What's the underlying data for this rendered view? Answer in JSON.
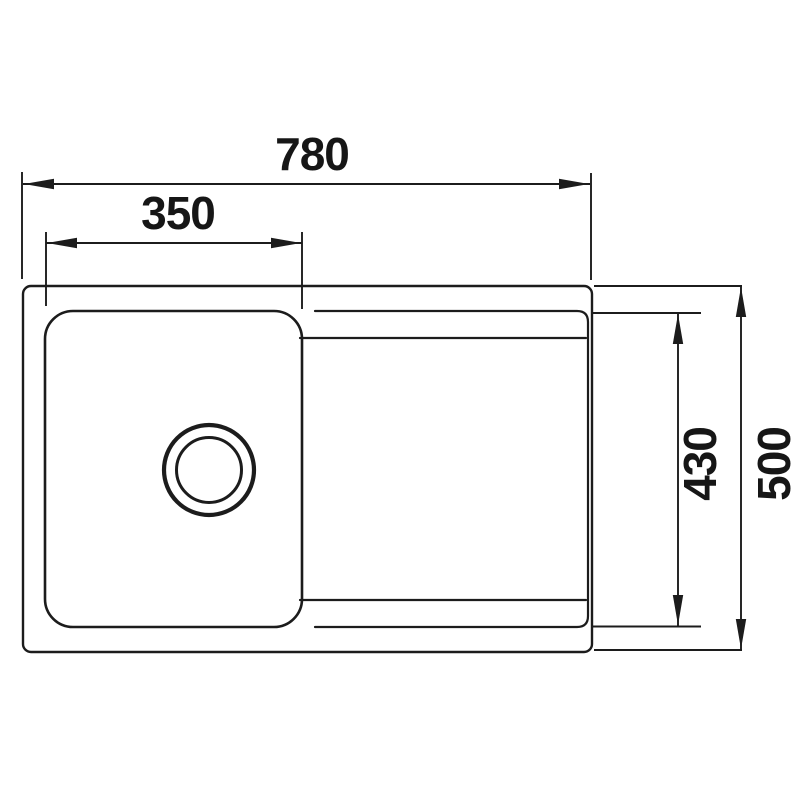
{
  "diagram": {
    "type": "technical-drawing",
    "subject": "kitchen sink with bowl and drainboard, top view, dimensioned",
    "colors": {
      "line": "#1c1c1c",
      "text": "#161616",
      "background": "#ffffff"
    },
    "dimensions": [
      {
        "id": "overall-width",
        "label": "780",
        "orientation": "horizontal",
        "measures": "overall sink width"
      },
      {
        "id": "bowl-width",
        "label": "350",
        "orientation": "horizontal",
        "measures": "bowl width"
      },
      {
        "id": "inner-depth",
        "label": "430",
        "orientation": "vertical",
        "measures": "inner recess depth"
      },
      {
        "id": "overall-depth",
        "label": "500",
        "orientation": "vertical",
        "measures": "overall sink depth"
      }
    ],
    "features": {
      "sink_outline": "rounded rectangle rim",
      "bowl": "rounded square bowl at left with circular drain",
      "drainboard": "recessed drainboard area at right",
      "drain": "concentric double circle drain hole"
    }
  }
}
